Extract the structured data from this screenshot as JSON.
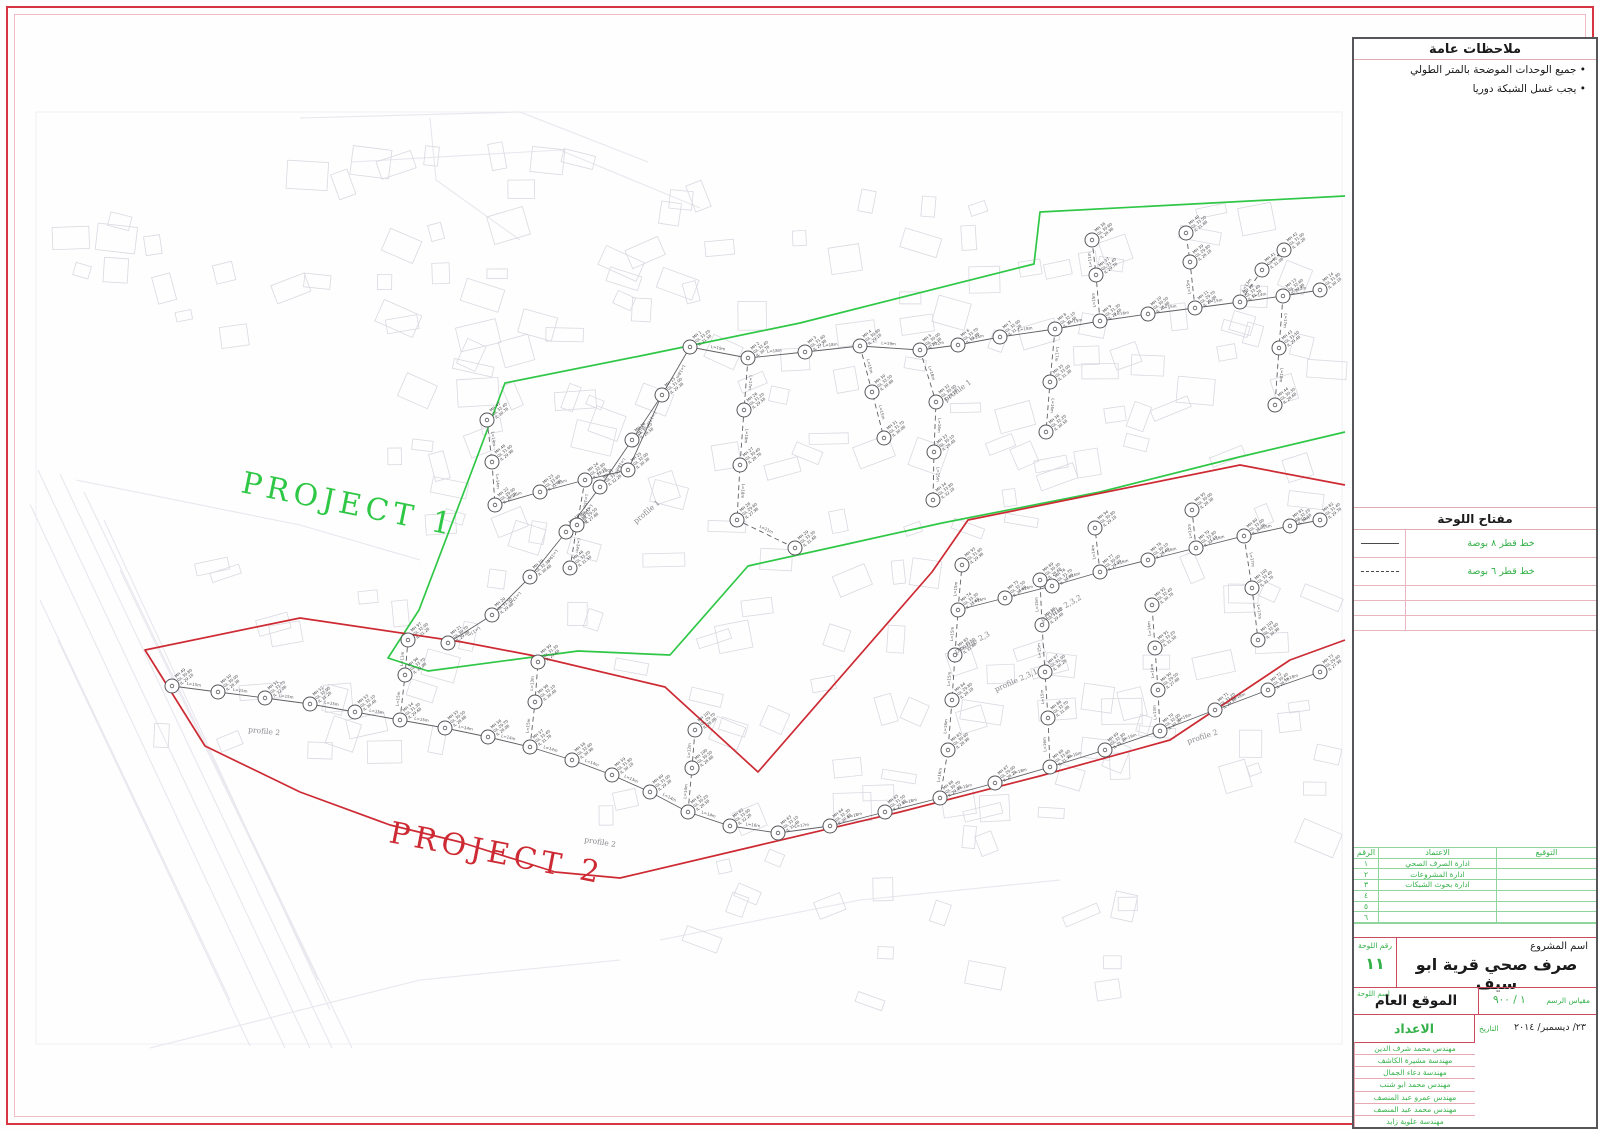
{
  "notes": {
    "title": "ملاحظات عامة",
    "items": [
      "جميع الوحدات الموضحة بالمتر الطولي",
      "يجب غسل الشبكة دوريا"
    ]
  },
  "legend": {
    "title": "مفتاح اللوحة",
    "rows": [
      {
        "line": "solid",
        "label": "خط قطر ٨ بوصة"
      },
      {
        "line": "dashed",
        "label": "خط قطر ٦ بوصة"
      },
      {
        "line": "",
        "label": ""
      },
      {
        "line": "",
        "label": ""
      },
      {
        "line": "",
        "label": ""
      }
    ]
  },
  "approvals": {
    "headers": {
      "no": "الرقم",
      "entity": "الاعتماد",
      "signature": "التوقيع"
    },
    "rows": [
      {
        "no": "١",
        "entity": "ادارة الصرف الصحي",
        "signature": ""
      },
      {
        "no": "٢",
        "entity": "ادارة المشروعات",
        "signature": ""
      },
      {
        "no": "٣",
        "entity": "ادارة بحوث الشبكات",
        "signature": ""
      },
      {
        "no": "٤",
        "entity": "",
        "signature": ""
      },
      {
        "no": "٥",
        "entity": "",
        "signature": ""
      },
      {
        "no": "٦",
        "entity": "",
        "signature": ""
      }
    ]
  },
  "title_block": {
    "project_name_label": "اسم المشروع",
    "project_name": "صرف صحي قرية ابو سيف",
    "sheet_no_label": "رقم اللوحة",
    "sheet_no": "١١",
    "sheet_name_label": "اسم اللوحة",
    "sheet_name": "الموقع العام",
    "scale_label": "مقياس الرسم",
    "scale": "١ / ٩٠٠",
    "date_label": "التاريخ",
    "date": "٢٣/ ديسمبر/ ٢٠١٤",
    "prepared_label": "الاعداد",
    "team": [
      "مهندس محمد شرف الدين",
      "مهندسة مشيرة الكاشف",
      "مهندسة دعاء الجمال",
      "مهندس محمد ابو شنب",
      "مهندس عمرو عبد المنصف",
      "مهندس محمد عبد المنصف",
      "مهندسة علوية زايد"
    ]
  },
  "map": {
    "project1": {
      "label": "PROJECT 1",
      "color": "#2fc746",
      "label_pos": [
        240,
        492
      ],
      "label_rot": 11.5,
      "label_size": 30,
      "boundary": [
        [
          1345,
          196
        ],
        [
          1040,
          212
        ],
        [
          1034,
          264
        ],
        [
          800,
          323
        ],
        [
          640,
          356
        ],
        [
          505,
          383
        ],
        [
          462,
          497
        ],
        [
          419,
          610
        ],
        [
          388,
          658
        ],
        [
          428,
          671
        ],
        [
          578,
          651
        ],
        [
          670,
          655
        ],
        [
          748,
          566
        ],
        [
          852,
          543
        ],
        [
          942,
          523
        ],
        [
          1100,
          492
        ],
        [
          1235,
          458
        ],
        [
          1345,
          432
        ]
      ]
    },
    "project2": {
      "label": "PROJECT 2",
      "color": "#cd2a33",
      "label_pos": [
        388,
        842
      ],
      "label_rot": 11,
      "label_size": 30,
      "boundary": [
        [
          1345,
          485
        ],
        [
          1240,
          465
        ],
        [
          968,
          520
        ],
        [
          932,
          572
        ],
        [
          758,
          772
        ],
        [
          665,
          687
        ],
        [
          530,
          655
        ],
        [
          462,
          642
        ],
        [
          300,
          618
        ],
        [
          145,
          650
        ],
        [
          205,
          746
        ],
        [
          300,
          792
        ],
        [
          390,
          825
        ],
        [
          460,
          842
        ],
        [
          555,
          872
        ],
        [
          620,
          878
        ],
        [
          760,
          845
        ],
        [
          900,
          812
        ],
        [
          1040,
          776
        ],
        [
          1170,
          740
        ],
        [
          1290,
          660
        ],
        [
          1345,
          640
        ]
      ]
    },
    "profiles": [
      {
        "text": "profile 1",
        "x": 946,
        "y": 402,
        "rot": -36
      },
      {
        "text": "profile 1",
        "x": 636,
        "y": 524,
        "rot": -40
      },
      {
        "text": "profile 2",
        "x": 248,
        "y": 732,
        "rot": 6
      },
      {
        "text": "profile 2",
        "x": 584,
        "y": 842,
        "rot": 9
      },
      {
        "text": "profile 2",
        "x": 1188,
        "y": 744,
        "rot": -18
      },
      {
        "text": "profile 2,3",
        "x": 956,
        "y": 654,
        "rot": -28
      },
      {
        "text": "profile 2,3,1",
        "x": 996,
        "y": 692,
        "rot": -24
      },
      {
        "text": "profile 2,3,2",
        "x": 1042,
        "y": 622,
        "rot": -30
      }
    ],
    "canal_lines": [
      [
        [
          14,
          470
        ],
        [
          285,
          1048
        ]
      ],
      [
        [
          38,
          470
        ],
        [
          310,
          1048
        ]
      ],
      [
        [
          60,
          474
        ],
        [
          332,
          1048
        ]
      ],
      [
        [
          84,
          492
        ],
        [
          352,
          1048
        ]
      ],
      [
        [
          104,
          520
        ],
        [
          330,
          1010
        ]
      ],
      [
        [
          40,
          600
        ],
        [
          230,
          1000
        ]
      ],
      [
        [
          58,
          640
        ],
        [
          250,
          1046
        ]
      ],
      [
        [
          120,
          570
        ],
        [
          318,
          980
        ]
      ],
      [
        [
          300,
          118
        ],
        [
          520,
          112
        ],
        [
          648,
          162
        ]
      ],
      [
        [
          352,
          162
        ],
        [
          560,
          150
        ],
        [
          700,
          208
        ]
      ],
      [
        [
          430,
          118
        ],
        [
          436,
          180
        ],
        [
          520,
          240
        ]
      ],
      [
        [
          76,
          480
        ],
        [
          300,
          525
        ],
        [
          420,
          560
        ]
      ],
      [
        [
          150,
          1048
        ],
        [
          420,
          980
        ],
        [
          620,
          960
        ]
      ],
      [
        [
          660,
          940
        ],
        [
          860,
          900
        ],
        [
          1060,
          880
        ]
      ]
    ],
    "building_zones": [
      {
        "n": 80,
        "x": 600,
        "y": 195,
        "w": 730,
        "h": 310
      },
      {
        "n": 70,
        "x": 600,
        "y": 515,
        "w": 730,
        "h": 330
      },
      {
        "n": 28,
        "x": 390,
        "y": 330,
        "w": 220,
        "h": 320
      },
      {
        "n": 18,
        "x": 150,
        "y": 560,
        "w": 300,
        "h": 220
      },
      {
        "n": 22,
        "x": 290,
        "y": 115,
        "w": 390,
        "h": 210
      },
      {
        "n": 16,
        "x": 620,
        "y": 855,
        "w": 520,
        "h": 150
      },
      {
        "n": 10,
        "x": 60,
        "y": 130,
        "w": 250,
        "h": 250
      }
    ],
    "networks": [
      {
        "name": "project-1-network",
        "pipes": [
          {
            "dashed": false,
            "pts": [
              [
                690,
                347
              ],
              [
                748,
                358
              ],
              [
                805,
                352
              ],
              [
                860,
                346
              ],
              [
                920,
                350
              ],
              [
                958,
                345
              ],
              [
                1000,
                337
              ],
              [
                1055,
                329
              ],
              [
                1100,
                321
              ],
              [
                1148,
                314
              ],
              [
                1195,
                308
              ],
              [
                1240,
                302
              ],
              [
                1283,
                296
              ],
              [
                1320,
                290
              ]
            ]
          },
          {
            "dashed": false,
            "pts": [
              [
                690,
                347
              ],
              [
                662,
                395
              ],
              [
                632,
                440
              ],
              [
                600,
                487
              ],
              [
                566,
                532
              ],
              [
                530,
                577
              ],
              [
                492,
                615
              ],
              [
                448,
                643
              ]
            ]
          },
          {
            "dashed": false,
            "pts": [
              [
                495,
                505
              ],
              [
                540,
                492
              ],
              [
                585,
                480
              ],
              [
                628,
                470
              ],
              [
                662,
                395
              ]
            ]
          },
          {
            "dashed": true,
            "pts": [
              [
                748,
                358
              ],
              [
                744,
                410
              ],
              [
                740,
                465
              ],
              [
                737,
                520
              ],
              [
                795,
                548
              ]
            ]
          },
          {
            "dashed": true,
            "pts": [
              [
                860,
                346
              ],
              [
                872,
                392
              ],
              [
                884,
                438
              ]
            ]
          },
          {
            "dashed": true,
            "pts": [
              [
                920,
                350
              ],
              [
                936,
                402
              ],
              [
                934,
                452
              ],
              [
                933,
                500
              ]
            ]
          },
          {
            "dashed": true,
            "pts": [
              [
                1055,
                329
              ],
              [
                1050,
                382
              ],
              [
                1046,
                432
              ]
            ]
          },
          {
            "dashed": true,
            "pts": [
              [
                1100,
                321
              ],
              [
                1096,
                275
              ],
              [
                1092,
                240
              ]
            ]
          },
          {
            "dashed": true,
            "pts": [
              [
                1195,
                308
              ],
              [
                1190,
                262
              ],
              [
                1186,
                233
              ]
            ]
          },
          {
            "dashed": true,
            "pts": [
              [
                1240,
                302
              ],
              [
                1262,
                270
              ],
              [
                1284,
                250
              ]
            ]
          },
          {
            "dashed": true,
            "pts": [
              [
                1283,
                296
              ],
              [
                1279,
                348
              ],
              [
                1275,
                405
              ]
            ]
          },
          {
            "dashed": true,
            "pts": [
              [
                585,
                480
              ],
              [
                577,
                525
              ],
              [
                570,
                568
              ]
            ]
          },
          {
            "dashed": true,
            "pts": [
              [
                487,
                420
              ],
              [
                492,
                462
              ],
              [
                495,
                505
              ]
            ]
          }
        ]
      },
      {
        "name": "project-2-network",
        "pipes": [
          {
            "dashed": false,
            "pts": [
              [
                172,
                686
              ],
              [
                218,
                692
              ],
              [
                265,
                698
              ],
              [
                310,
                704
              ],
              [
                355,
                712
              ],
              [
                400,
                720
              ],
              [
                445,
                728
              ],
              [
                488,
                737
              ],
              [
                530,
                747
              ],
              [
                572,
                760
              ],
              [
                612,
                775
              ],
              [
                650,
                792
              ],
              [
                688,
                812
              ],
              [
                730,
                826
              ],
              [
                778,
                833
              ],
              [
                830,
                826
              ],
              [
                885,
                812
              ],
              [
                940,
                798
              ],
              [
                995,
                783
              ],
              [
                1050,
                767
              ],
              [
                1105,
                750
              ],
              [
                1160,
                731
              ],
              [
                1215,
                710
              ],
              [
                1268,
                690
              ],
              [
                1320,
                672
              ]
            ]
          },
          {
            "dashed": false,
            "pts": [
              [
                958,
                610
              ],
              [
                1005,
                598
              ],
              [
                1052,
                586
              ],
              [
                1100,
                572
              ],
              [
                1148,
                560
              ],
              [
                1196,
                548
              ],
              [
                1244,
                536
              ],
              [
                1290,
                526
              ],
              [
                1320,
                520
              ]
            ]
          },
          {
            "dashed": true,
            "pts": [
              [
                940,
                798
              ],
              [
                948,
                750
              ],
              [
                952,
                700
              ],
              [
                955,
                655
              ],
              [
                958,
                610
              ]
            ]
          },
          {
            "dashed": true,
            "pts": [
              [
                1050,
                767
              ],
              [
                1048,
                718
              ],
              [
                1045,
                672
              ],
              [
                1042,
                625
              ],
              [
                1040,
                580
              ]
            ]
          },
          {
            "dashed": true,
            "pts": [
              [
                1160,
                731
              ],
              [
                1158,
                690
              ],
              [
                1155,
                648
              ],
              [
                1152,
                605
              ]
            ]
          },
          {
            "dashed": true,
            "pts": [
              [
                958,
                610
              ],
              [
                962,
                565
              ]
            ]
          },
          {
            "dashed": true,
            "pts": [
              [
                1100,
                572
              ],
              [
                1095,
                528
              ]
            ]
          },
          {
            "dashed": true,
            "pts": [
              [
                1196,
                548
              ],
              [
                1192,
                510
              ]
            ]
          },
          {
            "dashed": true,
            "pts": [
              [
                400,
                720
              ],
              [
                405,
                675
              ],
              [
                408,
                640
              ]
            ]
          },
          {
            "dashed": true,
            "pts": [
              [
                530,
                747
              ],
              [
                535,
                702
              ],
              [
                538,
                662
              ]
            ]
          },
          {
            "dashed": true,
            "pts": [
              [
                688,
                812
              ],
              [
                692,
                768
              ],
              [
                695,
                730
              ]
            ]
          },
          {
            "dashed": true,
            "pts": [
              [
                1244,
                536
              ],
              [
                1252,
                588
              ],
              [
                1258,
                640
              ]
            ]
          }
        ]
      }
    ]
  },
  "colors": {
    "border_red": "#d7353f",
    "panel_green_text": "#35b14a",
    "pink_line": "#e2aab3",
    "network_line": "#606065"
  }
}
